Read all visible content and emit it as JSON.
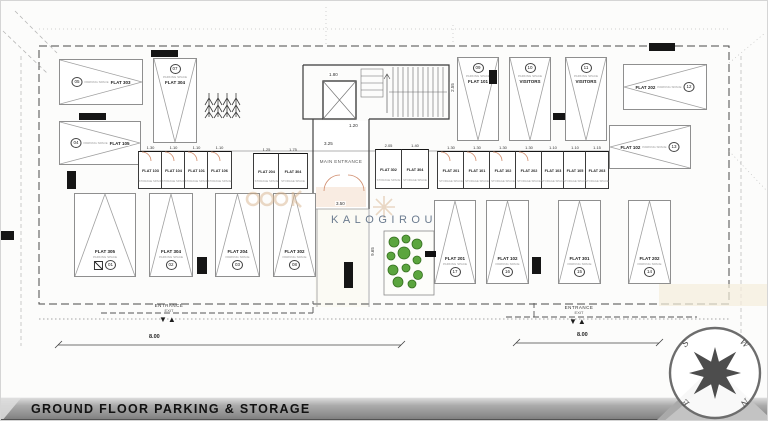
{
  "title_bar": {
    "label": "GROUND FLOOR PARKING & STORAGE"
  },
  "watermark": {
    "brand": "KALOGIROU"
  },
  "colors": {
    "brand_blue": "#64758a",
    "logo_tan": "#d8b48e",
    "shrub_green": "#5ba53e",
    "bar_dark": "#141414"
  },
  "plan": {
    "main_entrance": "MAIN ENTRANCE",
    "parking_sub": "PARKING SPACE",
    "storage_sub": "STORAGE SPACE",
    "ramp_arrows": "▼▲",
    "parking": [
      {
        "label": "FLAT 303",
        "num": "05"
      },
      {
        "label": "FLAT 105",
        "num": "04"
      },
      {
        "label": "FLAT 304",
        "num": "07"
      },
      {
        "label": "FLAT 101",
        "num": "09"
      },
      {
        "label": "VISITORS",
        "num": "10"
      },
      {
        "label": "VISITORS",
        "num": "11"
      },
      {
        "label": "FLAT 202",
        "num": "12"
      },
      {
        "label": "FLAT 102",
        "num": "13"
      },
      {
        "label": "FLAT 305",
        "num": "01"
      },
      {
        "label": "FLAT 304",
        "num": "02"
      },
      {
        "label": "FLAT 204",
        "num": "03"
      },
      {
        "label": "FLAT 302",
        "num": "08"
      },
      {
        "label": "FLAT 201",
        "num": "17"
      },
      {
        "label": "FLAT 102",
        "num": "16"
      },
      {
        "label": "FLAT 301",
        "num": "15"
      },
      {
        "label": "FLAT 202",
        "num": "14"
      }
    ],
    "storage": [
      {
        "label": "FLAT 103",
        "dim": "1.30"
      },
      {
        "label": "FLAT 104",
        "dim": "1.10"
      },
      {
        "label": "FLAT 101",
        "dim": "1.10"
      },
      {
        "label": "FLAT 106",
        "dim": "1.10"
      },
      {
        "label": "FLAT 204",
        "dim": "1.25"
      },
      {
        "label": "FLAT 304",
        "dim": "1.75"
      },
      {
        "label": "FLAT 302",
        "dim": "2.05"
      },
      {
        "label": "FLAT 304",
        "dim": "1.40"
      },
      {
        "label": "FLAT 201",
        "dim": "1.30"
      },
      {
        "label": "FLAT 101",
        "dim": "1.30"
      },
      {
        "label": "FLAT 102",
        "dim": "1.30"
      },
      {
        "label": "FLAT 202",
        "dim": "1.30"
      },
      {
        "label": "FLAT 103",
        "dim": "1.10"
      },
      {
        "label": "FLAT 105",
        "dim": "1.10"
      },
      {
        "label": "FLAT 203",
        "dim": "1.15"
      }
    ],
    "dims": [
      "3.25",
      "3.50",
      "9.65",
      "2.55",
      "1.80",
      "1.20"
    ],
    "entrance_left": {
      "line1": "ENTRANCE",
      "line2": "EXIT",
      "dim": "8.00"
    },
    "entrance_right": {
      "line1": "ENTRANCE",
      "line2": "EXIT",
      "dim": "8.00"
    },
    "compass": {
      "nw": "S",
      "ne": "W",
      "sw": "E",
      "se": "N"
    }
  }
}
